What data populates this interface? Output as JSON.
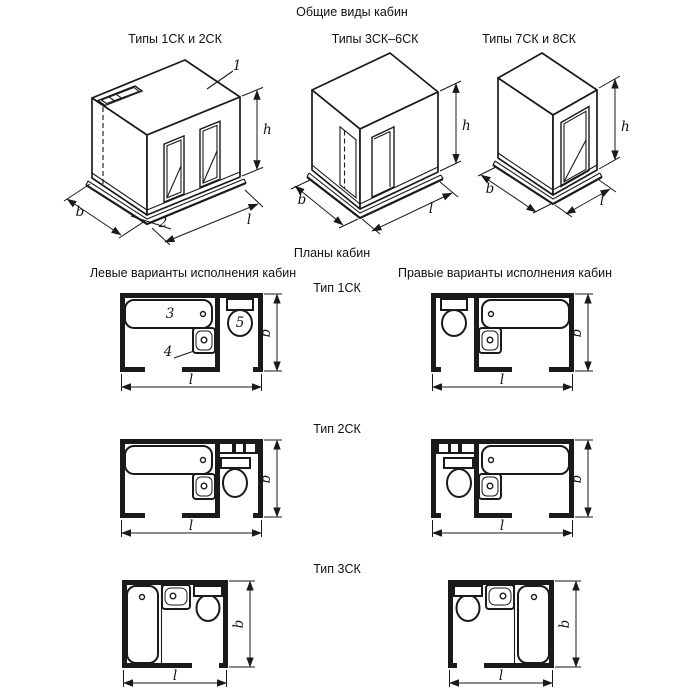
{
  "page": {
    "title": "Общие виды кабин",
    "plans_title": "Планы кабин",
    "left_header": "Левые варианты исполнения кабин",
    "right_header": "Правые варианты исполнения кабин"
  },
  "views": {
    "v1": {
      "label": "Типы 1СК и 2СК"
    },
    "v2": {
      "label": "Типы 3СК–6СК"
    },
    "v3": {
      "label": "Типы 7СК и 8СК"
    }
  },
  "types": {
    "t1": "Тип 1СК",
    "t2": "Тип 2СК",
    "t3": "Тип 3СК"
  },
  "dims": {
    "h": "h",
    "b": "b",
    "l": "l"
  },
  "callouts": {
    "c1": "1",
    "c2": "2",
    "c3": "3",
    "c4": "4",
    "c5": "5"
  },
  "colors": {
    "ink": "#1a1a1a",
    "background": "#ffffff"
  }
}
